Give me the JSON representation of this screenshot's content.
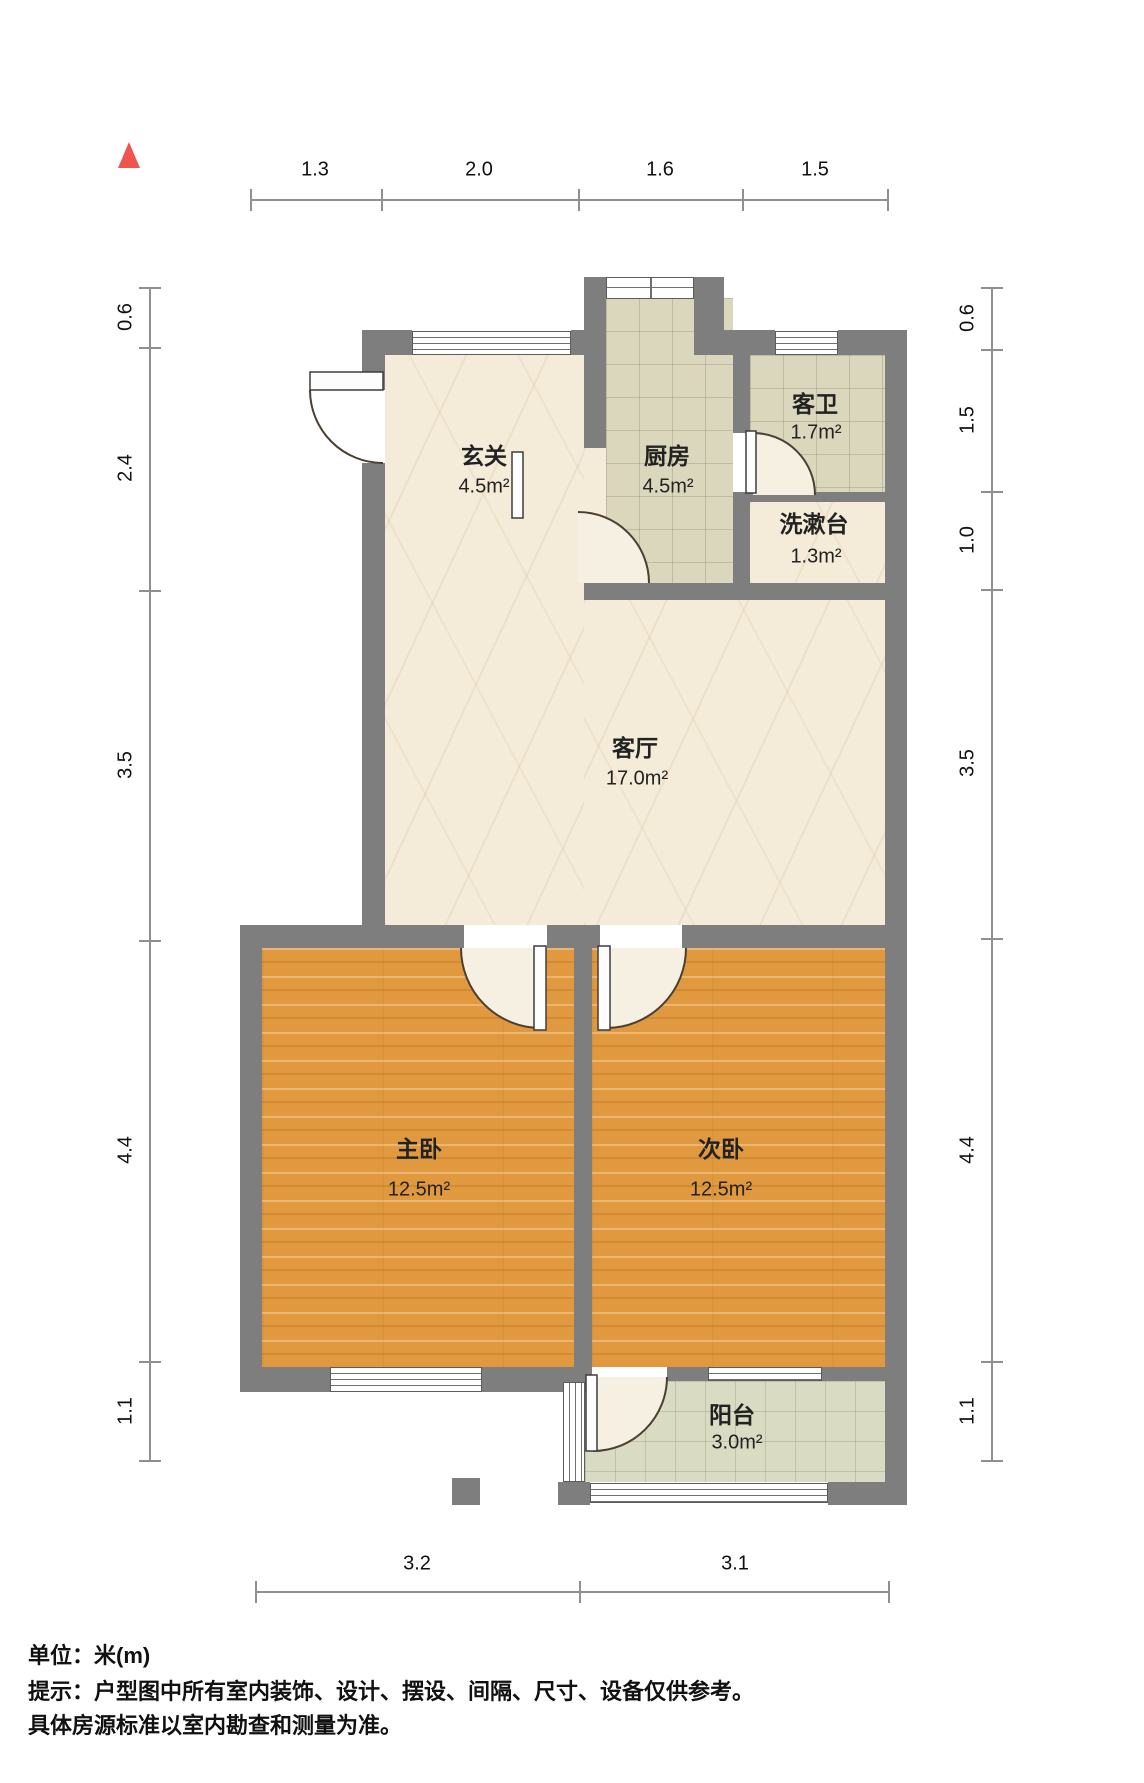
{
  "title": "户型图",
  "north_indicator": "north-arrow",
  "rooms": {
    "xuanguan": {
      "name": "玄关",
      "area": "4.5m²"
    },
    "chufang": {
      "name": "厨房",
      "area": "4.5m²"
    },
    "kewei": {
      "name": "客卫",
      "area": "1.7m²"
    },
    "xishutai": {
      "name": "洗漱台",
      "area": "1.3m²"
    },
    "keting": {
      "name": "客厅",
      "area": "17.0m²"
    },
    "zhuwo": {
      "name": "主卧",
      "area": "12.5m²"
    },
    "ciwo": {
      "name": "次卧",
      "area": "12.5m²"
    },
    "yangtai": {
      "name": "阳台",
      "area": "3.0m²"
    }
  },
  "dimensions": {
    "top": [
      "1.3",
      "2.0",
      "1.6",
      "1.5"
    ],
    "left": [
      "0.6",
      "2.4",
      "3.5",
      "4.4",
      "1.1"
    ],
    "right": [
      "0.6",
      "1.5",
      "1.0",
      "3.5",
      "4.4",
      "1.1"
    ],
    "bottom": [
      "3.2",
      "3.1"
    ]
  },
  "footer": {
    "unit": "单位：米(m)",
    "tip_line1": "提示：户型图中所有室内装饰、设计、摆设、间隔、尺寸、设备仅供参考。",
    "tip_line2": "具体房源标准以室内勘查和测量为准。"
  },
  "colors": {
    "wall": "#7e7e7e",
    "dim": "#8f8f8f",
    "north": "#f0544f",
    "wood": "#e0993f",
    "marble": "#f4ebd9",
    "tile": "#dbd7bc",
    "balcony_tile": "#d9dcc2",
    "door_wedge": "#f6f0e2"
  }
}
